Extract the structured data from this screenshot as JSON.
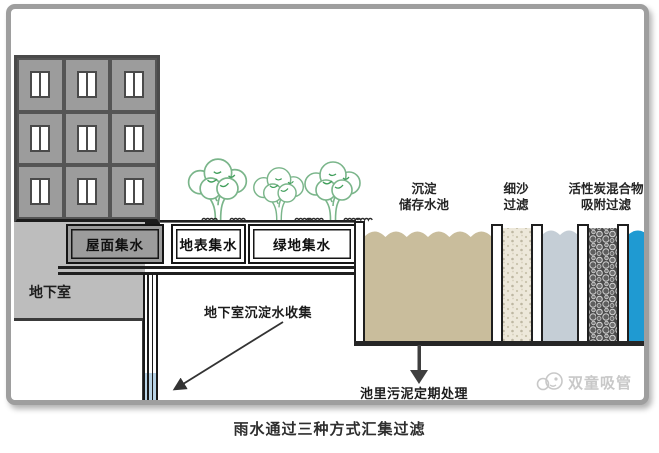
{
  "diagram": {
    "title_caption": "雨水通过三种方式汇集过滤",
    "building": {
      "basement_label": "地下室"
    },
    "collectors": [
      {
        "id": "roof",
        "label": "屋面集水"
      },
      {
        "id": "surface",
        "label": "地表集水"
      },
      {
        "id": "green",
        "label": "绿地集水"
      }
    ],
    "tanks": [
      {
        "id": "sedimentation",
        "label_line1": "沉淀",
        "label_line2": "储存水池"
      },
      {
        "id": "sand-filter",
        "label_line1": "细沙",
        "label_line2": "过滤"
      },
      {
        "id": "carbon-filter",
        "label_line1": "活性炭混合物",
        "label_line2": "吸附过滤"
      }
    ],
    "annotations": {
      "basement_collection": "地下室沉淀水收集",
      "sludge_treatment": "池里污泥定期处理"
    },
    "watermark": "双童吸管",
    "colors": {
      "building_gray": "#9c9c9c",
      "basement_gray": "#bdbdbd",
      "sediment_water": "#c9bd9c",
      "sand_filter": "#ede8da",
      "settled_water": "#c5ced6",
      "clean_water": "#1f9ad2",
      "pipe_water": "#b9d4e7",
      "carbon_dark": "#4c4c4c",
      "tree_green": "#7ab58a",
      "outline": "#1f1f1f",
      "frame_gray": "#9e9e9e",
      "watermark_gray": "#c8c8c8"
    }
  }
}
